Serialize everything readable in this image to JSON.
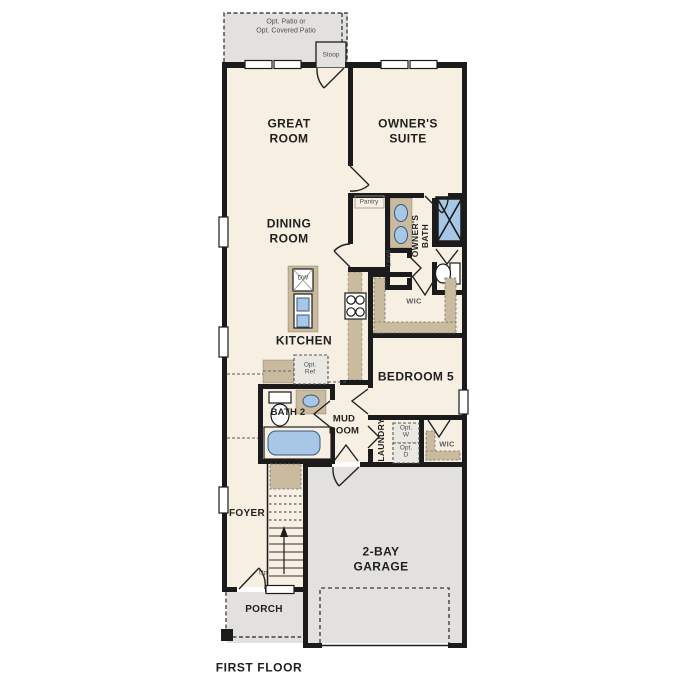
{
  "floor_plan": {
    "title": "FIRST FLOOR",
    "rooms": {
      "great_room": "GREAT\nROOM",
      "owners_suite": "OWNER'S\nSUITE",
      "dining_room": "DINING\nROOM",
      "kitchen": "KITCHEN",
      "pantry": "Pantry",
      "owners_bath": "OWNER'S\nBATH",
      "linen": "Linen",
      "owners_wic": "WIC",
      "bedroom5": "BEDROOM 5",
      "bath2": "BATH 2",
      "mud_room": "MUD\nROOM",
      "laundry": "LAUNDRY",
      "laundry_wic": "WIC",
      "foyer": "FOYER",
      "garage": "2-BAY\nGARAGE",
      "porch": "PORCH"
    },
    "annotations": {
      "opt_patio": "Opt. Patio or\nOpt. Covered Patio",
      "stoop": "Stoop",
      "dishwasher": "DW",
      "opt_ref": "Opt.\nRef",
      "opt_washer": "Opt.\nW",
      "opt_dryer": "Opt.\nD",
      "up": "Up"
    },
    "colors": {
      "wall": "#1b1b1b",
      "floor": "#f6efe2",
      "concrete": "#e2e1de",
      "cabinet": "#cabb9f",
      "fixture": "#a8c7e7",
      "text": "#1f1f1f",
      "text_muted": "#4f4f4f"
    }
  }
}
